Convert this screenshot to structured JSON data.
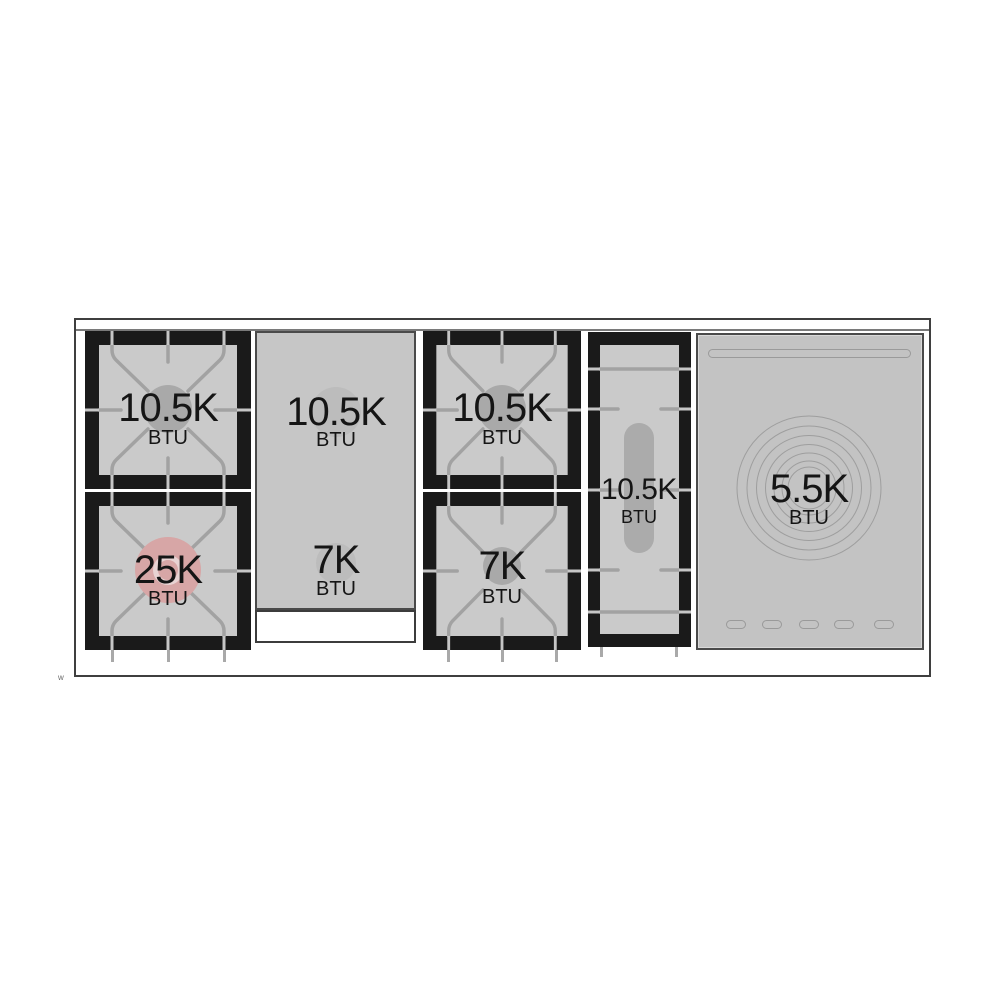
{
  "diagram_kind": "range-top burner power diagram",
  "zones": {
    "left_rear": {
      "value": "10.5K",
      "unit": "BTU"
    },
    "left_front": {
      "value": "25K",
      "unit": "BTU"
    },
    "griddle_rear": {
      "value": "10.5K",
      "unit": "BTU"
    },
    "griddle_front": {
      "value": "7K",
      "unit": "BTU"
    },
    "center_rear": {
      "value": "10.5K",
      "unit": "BTU"
    },
    "center_front": {
      "value": "7K",
      "unit": "BTU"
    },
    "oval": {
      "value": "10.5K",
      "unit": "BTU"
    },
    "warming": {
      "value": "5.5K",
      "unit": "BTU"
    }
  },
  "footnote_mark": "w",
  "colors": {
    "grate_frame": "#1a1a1a",
    "burner_surface": "#cacaca",
    "griddle_surface": "#c6c6c6",
    "warming_surface": "#c3c3c3",
    "grate_line": "#a2a2a2",
    "burner_cap": "#a9a9a9",
    "power_burner_cap": "#d7a6a6",
    "power_burner_ring": "#e8d3d3",
    "outline": "#3f3f3f"
  }
}
